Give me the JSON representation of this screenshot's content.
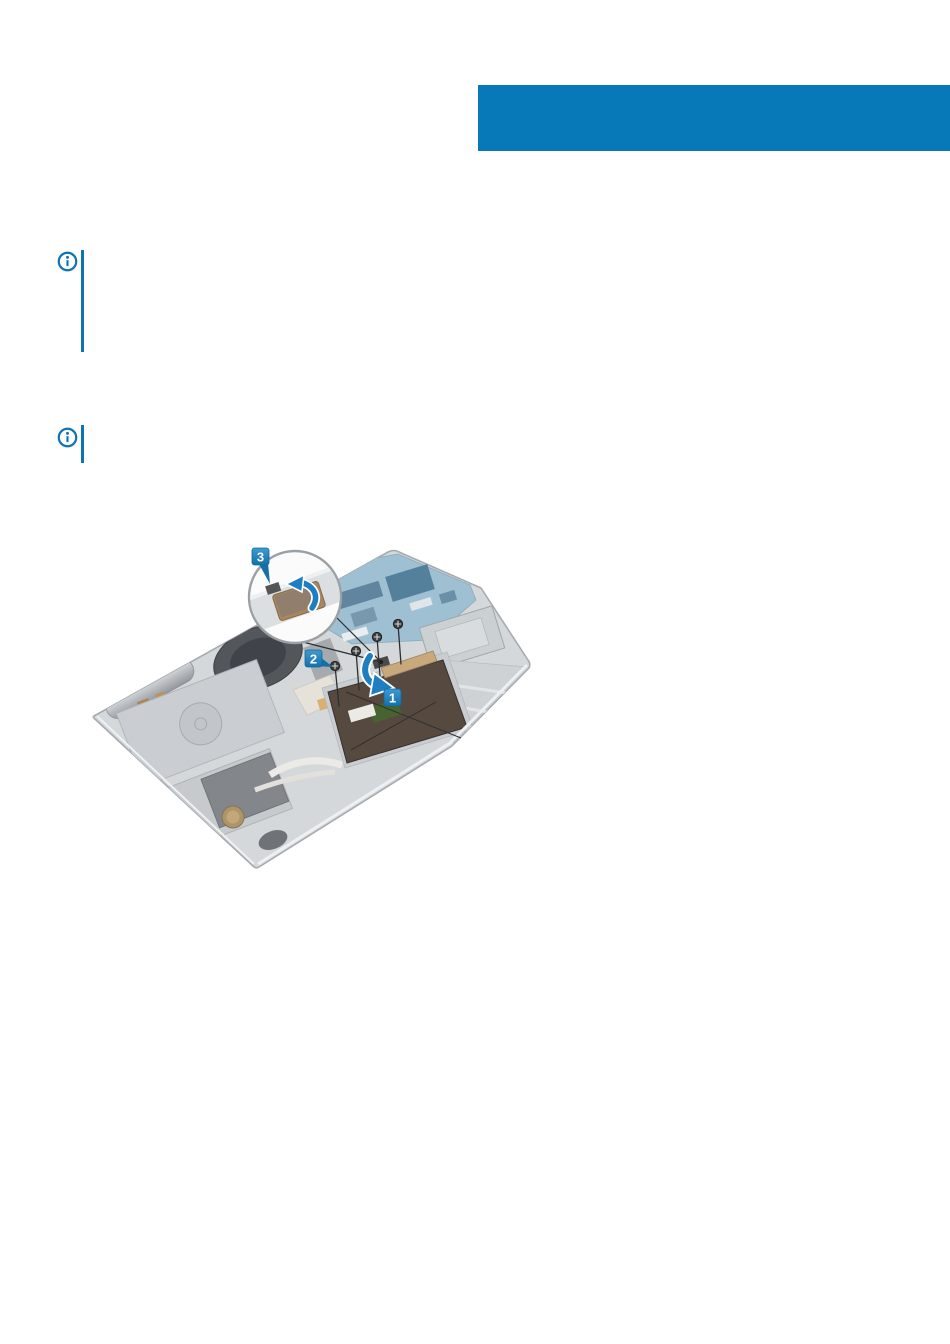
{
  "title_bar": {
    "background": "#0779b8"
  },
  "notes": [
    {
      "icon": "info-icon",
      "accent_color": "#0d73b2"
    },
    {
      "icon": "info-icon",
      "accent_color": "#0d73b2"
    }
  ],
  "figure": {
    "type": "exploded-view-illustration",
    "callouts": [
      {
        "label": "1"
      },
      {
        "label": "2"
      },
      {
        "label": "3"
      }
    ],
    "screw_count": 4,
    "colors": {
      "callout_blue_top": "#3f9ad2",
      "callout_blue_bottom": "#1470a8",
      "arrow_blue": "#1d7ec2",
      "body_gray": "#d5d8db",
      "touchpad": "#564a40",
      "board_blue": "#9fc0d2",
      "tape_tan": "#a8865f"
    }
  }
}
